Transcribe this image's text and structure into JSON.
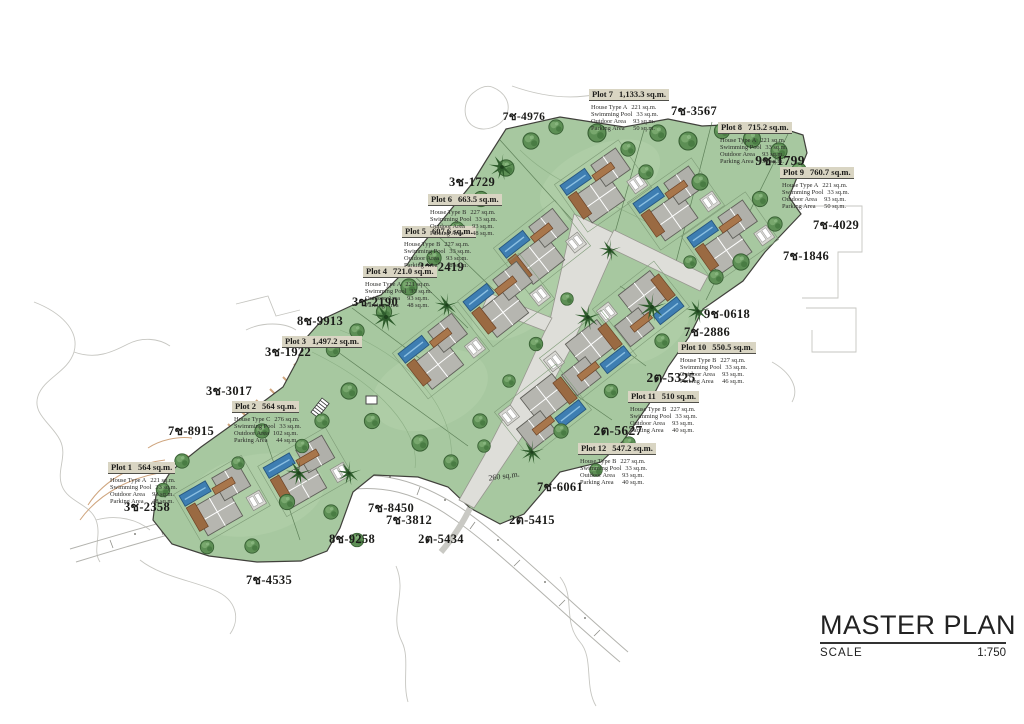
{
  "title_block": {
    "title": "MASTER PLAN",
    "scale_label": "SCALE",
    "scale_value": "1:750"
  },
  "map": {
    "area_note": {
      "label": "260 sq.m.",
      "x": 504,
      "y": 476
    },
    "plots": [
      {
        "name": "Plot 1",
        "area": "564 sq.m.",
        "x": 108,
        "y": 457,
        "details": [
          [
            "House Type A",
            "221 sq.m."
          ],
          [
            "Swimming Pool",
            "33 sq.m."
          ],
          [
            "Outdoor Area",
            "93 sq.m."
          ],
          [
            "Parking Area",
            "48 sq.m."
          ]
        ]
      },
      {
        "name": "Plot 2",
        "area": "564 sq.m.",
        "x": 232,
        "y": 396,
        "details": [
          [
            "House Type C",
            "276 sq.m."
          ],
          [
            "Swimming Pool",
            "33 sq.m."
          ],
          [
            "Outdoor Area",
            "102 sq.m."
          ],
          [
            "Parking Area",
            "44 sq.m."
          ]
        ]
      },
      {
        "name": "Plot 3",
        "area": "1,497.2 sq.m.",
        "x": 282,
        "y": 331,
        "details": []
      },
      {
        "name": "Plot 4",
        "area": "721.0 sq.m.",
        "x": 363,
        "y": 261,
        "details": [
          [
            "House Type A",
            "221 sq.m."
          ],
          [
            "Swimming Pool",
            "33 sq.m."
          ],
          [
            "Outdoor Area",
            "93 sq.m."
          ],
          [
            "Parking Area",
            "48 sq.m."
          ]
        ]
      },
      {
        "name": "Plot 5",
        "area": "607.6 sq.m.",
        "x": 402,
        "y": 221,
        "details": [
          [
            "House Type B",
            "227 sq.m."
          ],
          [
            "Swimming Pool",
            "33 sq.m."
          ],
          [
            "Outdoor Area",
            "93 sq.m."
          ],
          [
            "Parking Area",
            "48 sq.m."
          ]
        ]
      },
      {
        "name": "Plot 6",
        "area": "663.5 sq.m.",
        "x": 428,
        "y": 189,
        "details": [
          [
            "House Type B",
            "227 sq.m."
          ],
          [
            "Swimming Pool",
            "33 sq.m."
          ],
          [
            "Outdoor Area",
            "93 sq.m."
          ],
          [
            "Parking Area",
            "48 sq.m."
          ]
        ]
      },
      {
        "name": "Plot 7",
        "area": "1,133.3 sq.m.",
        "x": 589,
        "y": 84,
        "details": [
          [
            "House Type A",
            "221 sq.m."
          ],
          [
            "Swimming Pool",
            "33 sq.m."
          ],
          [
            "Outdoor Area",
            "93 sq.m."
          ],
          [
            "Parking Area",
            "50 sq.m."
          ]
        ]
      },
      {
        "name": "Plot 8",
        "area": "715.2 sq.m.",
        "x": 718,
        "y": 117,
        "details": [
          [
            "House Type A",
            "221 sq.m."
          ],
          [
            "Swimming Pool",
            "33 sq.m."
          ],
          [
            "Outdoor Area",
            "93 sq.m."
          ],
          [
            "Parking Area",
            "50 sq.m."
          ]
        ]
      },
      {
        "name": "Plot 9",
        "area": "760.7 sq.m.",
        "x": 780,
        "y": 162,
        "details": [
          [
            "House Type A",
            "221 sq.m."
          ],
          [
            "Swimming Pool",
            "33 sq.m."
          ],
          [
            "Outdoor Area",
            "93 sq.m."
          ],
          [
            "Parking Area",
            "50 sq.m."
          ]
        ]
      },
      {
        "name": "Plot 10",
        "area": "550.5 sq.m.",
        "x": 678,
        "y": 337,
        "details": [
          [
            "House Type B",
            "227 sq.m."
          ],
          [
            "Swimming Pool",
            "33 sq.m."
          ],
          [
            "Outdoor Area",
            "93 sq.m."
          ],
          [
            "Parking Area",
            "46 sq.m."
          ]
        ]
      },
      {
        "name": "Plot 11",
        "area": "510 sq.m.",
        "x": 628,
        "y": 386,
        "details": [
          [
            "House Type B",
            "227 sq.m."
          ],
          [
            "Swimming Pool",
            "33 sq.m."
          ],
          [
            "Outdoor Area",
            "93 sq.m."
          ],
          [
            "Parking Area",
            "40 sq.m."
          ]
        ]
      },
      {
        "name": "Plot 12",
        "area": "547.2 sq.m.",
        "x": 578,
        "y": 438,
        "details": [
          [
            "House Type B",
            "227 sq.m."
          ],
          [
            "Swimming Pool",
            "33 sq.m."
          ],
          [
            "Outdoor Area",
            "93 sq.m."
          ],
          [
            "Parking Area",
            "40 sq.m."
          ]
        ]
      }
    ],
    "parcels": [
      {
        "label": "7ช-4976",
        "x": 524,
        "y": 117,
        "size": 11.5
      },
      {
        "label": "7ช-3567",
        "x": 694,
        "y": 111
      },
      {
        "label": "9ช-1799",
        "x": 780,
        "y": 160,
        "size": 13.5
      },
      {
        "label": "3ช-1729",
        "x": 472,
        "y": 182
      },
      {
        "label": "7ช-4029",
        "x": 836,
        "y": 225
      },
      {
        "label": "7ช-1846",
        "x": 806,
        "y": 256
      },
      {
        "label": "3ช-2419",
        "x": 441,
        "y": 267
      },
      {
        "label": "3ช-2190",
        "x": 375,
        "y": 302
      },
      {
        "label": "8ช-9913",
        "x": 320,
        "y": 321
      },
      {
        "label": "3ช-1922",
        "x": 288,
        "y": 352
      },
      {
        "label": "9ช-0618",
        "x": 727,
        "y": 314
      },
      {
        "label": "7ช-2886",
        "x": 707,
        "y": 332
      },
      {
        "label": "2ต-5325",
        "x": 671,
        "y": 377,
        "size": 13.5
      },
      {
        "label": "3ช-3017",
        "x": 229,
        "y": 391
      },
      {
        "label": "7ช-8915",
        "x": 191,
        "y": 431
      },
      {
        "label": "2ต-5627",
        "x": 618,
        "y": 430,
        "size": 13.5
      },
      {
        "label": "3ช-2358",
        "x": 147,
        "y": 507
      },
      {
        "label": "7ช-6061",
        "x": 560,
        "y": 487
      },
      {
        "label": "2ต-5415",
        "x": 532,
        "y": 520
      },
      {
        "label": "7ช-8450",
        "x": 391,
        "y": 508
      },
      {
        "label": "7ช-3812",
        "x": 409,
        "y": 520
      },
      {
        "label": "8ช-9258",
        "x": 352,
        "y": 539
      },
      {
        "label": "2ต-5434",
        "x": 441,
        "y": 539
      },
      {
        "label": "7ช-4535",
        "x": 269,
        "y": 580
      }
    ],
    "colors": {
      "site_green": "#a7c8a0",
      "tree_green": "#55854e",
      "pool_blue": "#3e7eb2",
      "deck_brown": "#9a6a42",
      "roof_gray": "#b6b6b0",
      "road_gray": "#deded9",
      "card_bg": "#d9d5c3",
      "contour_tan": "#cfa57e"
    },
    "icons": [
      "tree-symbol",
      "palm-tree-symbol",
      "house-roof-plan-symbol",
      "swimming-pool-symbol"
    ]
  }
}
